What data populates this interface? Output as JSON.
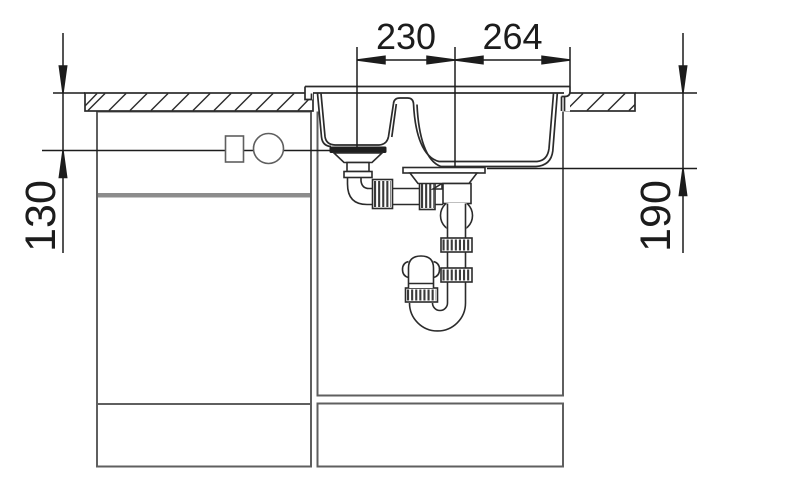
{
  "drawing": {
    "title": "Sink installation cross-section drawing",
    "type": "technical-drawing",
    "subject": "one-and-a-half bowl kitchen sink with base cabinets and drain plumbing",
    "labels": {
      "dim_top_left": "230",
      "dim_top_right": "264",
      "dim_left": "130",
      "dim_right": "190"
    },
    "colors": {
      "background": "#ffffff",
      "dimension_line": "#1c1c1c",
      "drawing_dark": "#2b2b2b",
      "cabinet_gray": "#5f5f5f",
      "shelf_band_gray": "#8c8c8c",
      "drain_seal_dark": "#1f1f1f"
    }
  }
}
